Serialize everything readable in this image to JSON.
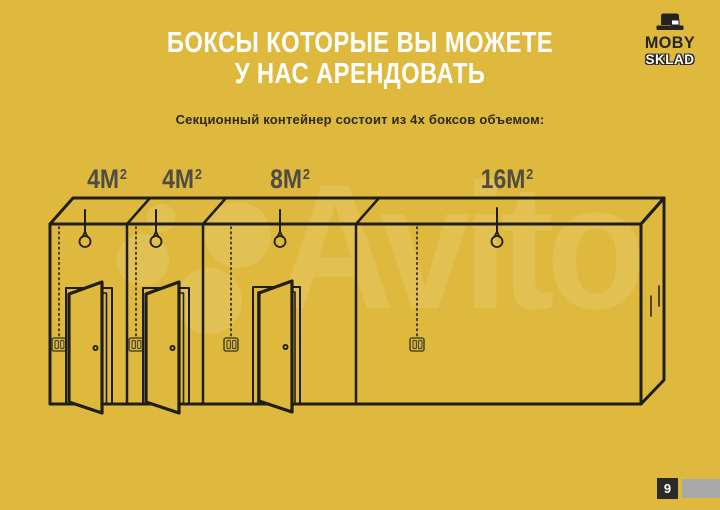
{
  "slide": {
    "colors": {
      "background": "#dfb93d",
      "ink": "#201e19",
      "label_gray": "#4e4c45",
      "title_white": "#ffffff",
      "badge_bg": "#2b2a26",
      "footer_strip_gray": "#a9a9a9"
    },
    "title": {
      "line1": "БОКСЫ КОТОРЫЕ ВЫ МОЖЕТЕ",
      "line2": "У НАС АРЕНДОВАТЬ"
    },
    "subtitle": "Секционный контейнер состоит из 4х боксов объемом:",
    "brand": {
      "name": "MOBY",
      "subname": "SKLAD",
      "icon": "stacked-boxes-icon"
    },
    "box_labels": [
      {
        "size": "4М",
        "sup": "2"
      },
      {
        "size": "4М",
        "sup": "2"
      },
      {
        "size": "8М",
        "sup": "2"
      },
      {
        "size": "16М",
        "sup": "2"
      }
    ],
    "diagram_icons": {
      "bulb": "light-bulb-icon",
      "switch": "light-switch-icon",
      "door": "open-door"
    },
    "watermark": {
      "text": "Avito"
    },
    "footer": {
      "page": "9"
    }
  }
}
